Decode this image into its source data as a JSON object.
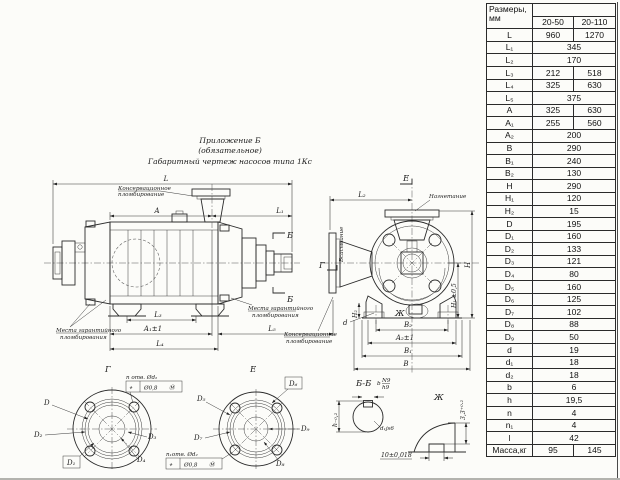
{
  "page": {
    "background": "#fcfcf9",
    "line_color": "#2b2b2b"
  },
  "title": {
    "line1": "Приложение Б",
    "line2": "(обязательное)",
    "line3": "Габаритный чертеж насосов типа 1Кс"
  },
  "notes": {
    "preservation_line1": "Консервационное",
    "preservation_line2": "пломбирование",
    "warranty_line1": "Места гарантийного",
    "warranty_line2": "пломбирования",
    "suction": "Всасывание",
    "discharge": "Нагнетание"
  },
  "views": {
    "g": "Г",
    "e": "Е",
    "b": "Б",
    "bb": "Б-Б",
    "zh": "Ж"
  },
  "dims": {
    "side": {
      "L": "L",
      "A": "A",
      "L1": "L₁",
      "L3": "L₃",
      "A1": "A₁±1",
      "L4": "L₄",
      "L5": "L₅"
    },
    "front": {
      "L2": "L₂",
      "H": "H",
      "H1": "H₁ ±0,5",
      "H2": "H₂",
      "d": "d",
      "B2": "B₂",
      "A2": "A₂±1",
      "B1": "B₁",
      "B": "B"
    },
    "flange_g": {
      "D": "D",
      "D1": "D₁",
      "D2": "D₂",
      "D3": "D₃",
      "D4": "D₄",
      "holes": "n отв. Ød₂"
    },
    "flange_e": {
      "D5": "D₅",
      "D6": "D₆",
      "D7": "D₇",
      "D8": "D₈",
      "D9": "D₉",
      "holes": "n₁отв. Ød₂"
    },
    "gdt": {
      "symbol": "⌖",
      "value": "Ø0,8",
      "modifier": "Ⓜ"
    },
    "section_bb": {
      "key_width": "b",
      "fit_num": "N9",
      "fit_den": "h9",
      "shaft": "d₁js6",
      "height": "h₋₀,₂",
      "slot": "10±0,018"
    },
    "zh": {
      "depth": "3,3⁺⁰·²"
    }
  },
  "table": {
    "header": {
      "col1_line1": "Размеры,",
      "col1_line2": "мм",
      "col2": "20-50",
      "col3": "20-110"
    },
    "rows": [
      {
        "label": "L",
        "v1": "960",
        "v2": "1270"
      },
      {
        "label": "L₁",
        "v": "345"
      },
      {
        "label": "L₂",
        "v": "170"
      },
      {
        "label": "L₃",
        "v1": "212",
        "v2": "518"
      },
      {
        "label": "L₄",
        "v1": "325",
        "v2": "630"
      },
      {
        "label": "L₅",
        "v": "375"
      },
      {
        "label": "A",
        "v1": "325",
        "v2": "630"
      },
      {
        "label": "A₁",
        "v1": "255",
        "v2": "560"
      },
      {
        "label": "A₂",
        "v": "200"
      },
      {
        "label": "B",
        "v": "290"
      },
      {
        "label": "B₁",
        "v": "240"
      },
      {
        "label": "B₂",
        "v": "130"
      },
      {
        "label": "H",
        "v": "290"
      },
      {
        "label": "H₁",
        "v": "120"
      },
      {
        "label": "H₂",
        "v": "15"
      },
      {
        "label": "D",
        "v": "195"
      },
      {
        "label": "D₁",
        "v": "160"
      },
      {
        "label": "D₂",
        "v": "133"
      },
      {
        "label": "D₃",
        "v": "121"
      },
      {
        "label": "D₄",
        "v": "80"
      },
      {
        "label": "D₅",
        "v": "160"
      },
      {
        "label": "D₆",
        "v": "125"
      },
      {
        "label": "D₇",
        "v": "102"
      },
      {
        "label": "D₈",
        "v": "88"
      },
      {
        "label": "D₉",
        "v": "50"
      },
      {
        "label": "d",
        "v": "19"
      },
      {
        "label": "d₁",
        "v": "18"
      },
      {
        "label": "d₂",
        "v": "18"
      },
      {
        "label": "b",
        "v": "6"
      },
      {
        "label": "h",
        "v": "19,5"
      },
      {
        "label": "n",
        "v": "4"
      },
      {
        "label": "n₁",
        "v": "4"
      },
      {
        "label": "l",
        "v": "42"
      },
      {
        "label": "Масса,кг",
        "v1": "95",
        "v2": "145"
      }
    ]
  }
}
